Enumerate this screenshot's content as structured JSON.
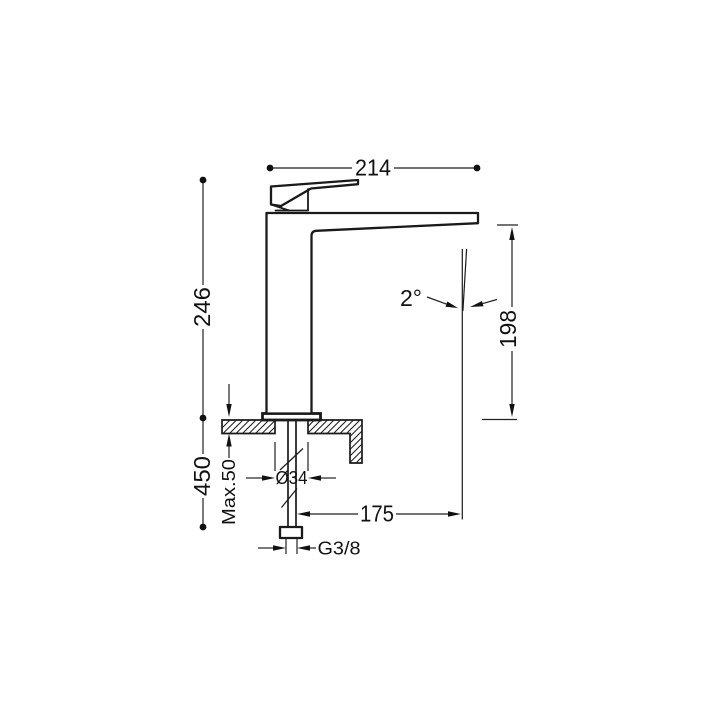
{
  "colors": {
    "background": "#ffffff",
    "line": "#1a1a1a",
    "text": "#111111"
  },
  "dims": {
    "overall_width": "214",
    "height_above_deck": "246",
    "length_below_deck": "450",
    "outlet_height": "198",
    "spout_reach": "175",
    "hole_diameter": "Ø34",
    "max_deck_thickness": "Max.50",
    "supply_thread": "G3/8",
    "stream_angle": "2°"
  }
}
